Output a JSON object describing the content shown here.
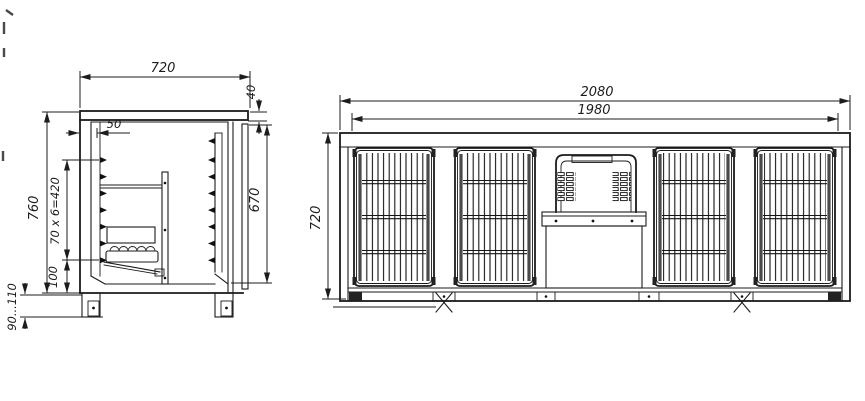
{
  "drawing": {
    "background": "#ffffff",
    "line_color": "#1b1b1b",
    "side_view": {
      "name": "side-section-view",
      "dim_width_top": "720",
      "dim_counter_thickness": "40",
      "dim_liner_offset": "50",
      "dim_body_height": "760",
      "dim_shelf_rails": "70 x 6=420",
      "dim_bottom_offset": "100",
      "dim_inner_height": "670",
      "dim_leg_height": "90...110"
    },
    "front_view": {
      "name": "front-view",
      "dim_overall_width": "2080",
      "dim_body_width": "1980",
      "dim_height": "720",
      "door_count": 4
    }
  }
}
